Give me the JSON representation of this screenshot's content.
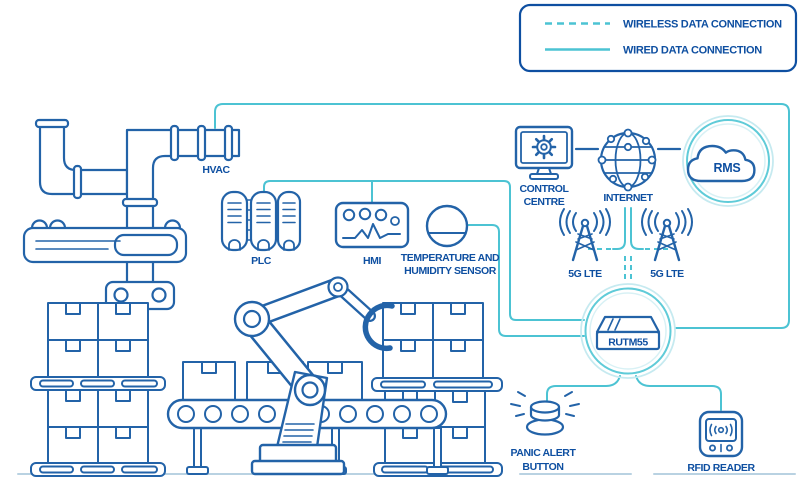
{
  "legend": {
    "wireless_label": "WIRELESS DATA CONNECTION",
    "wired_label": "WIRED DATA CONNECTION"
  },
  "nodes": {
    "hvac": {
      "label": "HVAC"
    },
    "plc": {
      "label": "PLC"
    },
    "hmi": {
      "label": "HMI"
    },
    "temp_sensor": {
      "line1": "TEMPERATURE AND",
      "line2": "HUMIDITY SENSOR"
    },
    "control_centre": {
      "line1": "CONTROL",
      "line2": "CENTRE"
    },
    "internet": {
      "label": "INTERNET"
    },
    "rms": {
      "label": "RMS"
    },
    "lte_left": {
      "label": "5G LTE"
    },
    "lte_right": {
      "label": "5G LTE"
    },
    "router": {
      "label": "RUTM55"
    },
    "panic_button": {
      "line1": "PANIC ALERT",
      "line2": "BUTTON"
    },
    "rfid_reader": {
      "label": "RFID READER"
    }
  },
  "colors": {
    "outline": "#2363a8",
    "text": "#0e4fa1",
    "wired": "#4cc3d3",
    "ring_light": "#c6eaf0",
    "ring_mid": "#5fcbd8",
    "ring_faint": "#d8f1f5",
    "ground": "#b9d2e2"
  }
}
